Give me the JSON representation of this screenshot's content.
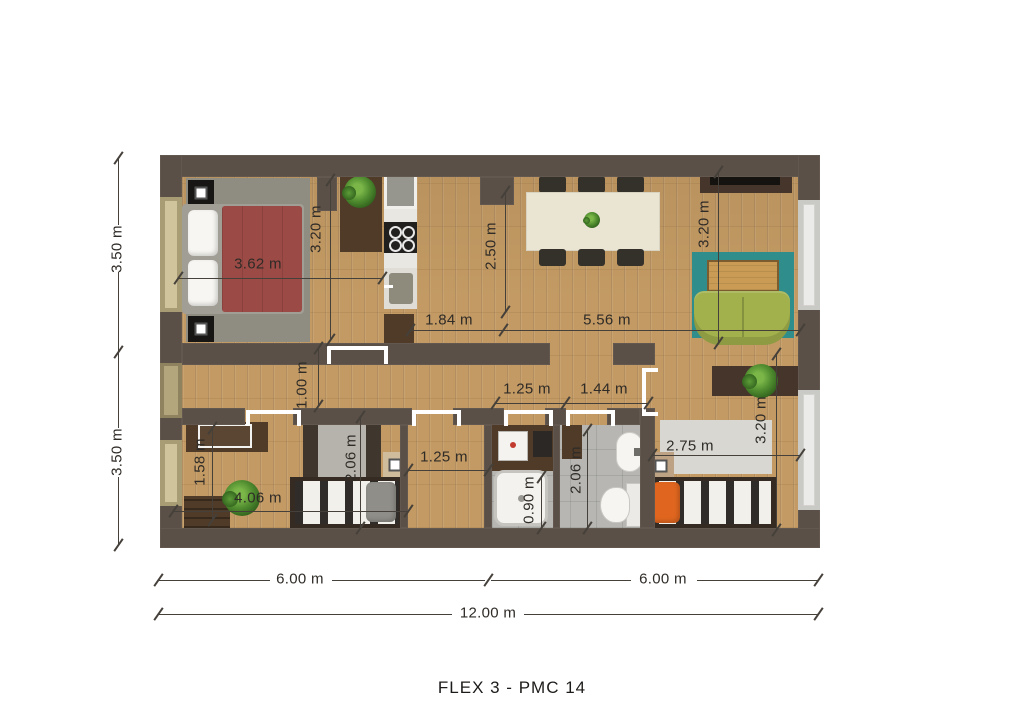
{
  "title": "FLEX 3 - PMC 14",
  "plan": {
    "overall": {
      "left_upper_depth": "3.50 m",
      "left_lower_depth": "3.50 m",
      "bottom_left_half": "6.00 m",
      "bottom_right_half": "6.00 m",
      "bottom_total": "12.00 m"
    },
    "rooms": {
      "bedroom1": {
        "width": "3.62 m",
        "depth": "3.20 m"
      },
      "kitchen": {
        "width": "1.84 m"
      },
      "dining": {
        "depth": "2.50 m"
      },
      "living": {
        "width": "5.56 m",
        "depth": "3.20 m"
      },
      "hallway": {
        "width": "1.00 m"
      },
      "laundry": {
        "width": "1.25 m"
      },
      "wc": {
        "width": "1.44 m",
        "depth": "2.06 m"
      },
      "shower": {
        "width": "0.90 m"
      },
      "closet": {
        "width": "1.25 m"
      },
      "bedroom2": {
        "width": "4.06 m",
        "depth": "2.06 m"
      },
      "entry": {
        "depth": "1.58 m"
      },
      "bedroom3": {
        "rug_width": "2.75 m",
        "depth": "3.20 m"
      }
    }
  },
  "colors": {
    "wall": "#5a5047",
    "wood": "#c39a63",
    "tile": "#b7b6b2",
    "bed_red": "#9b4a45",
    "rug_teal": "#2f8e8b",
    "sofa_green": "#a2b14c",
    "pillow_orange": "#e0661f",
    "rug_grey": "#8f8d81",
    "dark_wood": "#4f3b28",
    "window_tan": "#a89c74"
  }
}
